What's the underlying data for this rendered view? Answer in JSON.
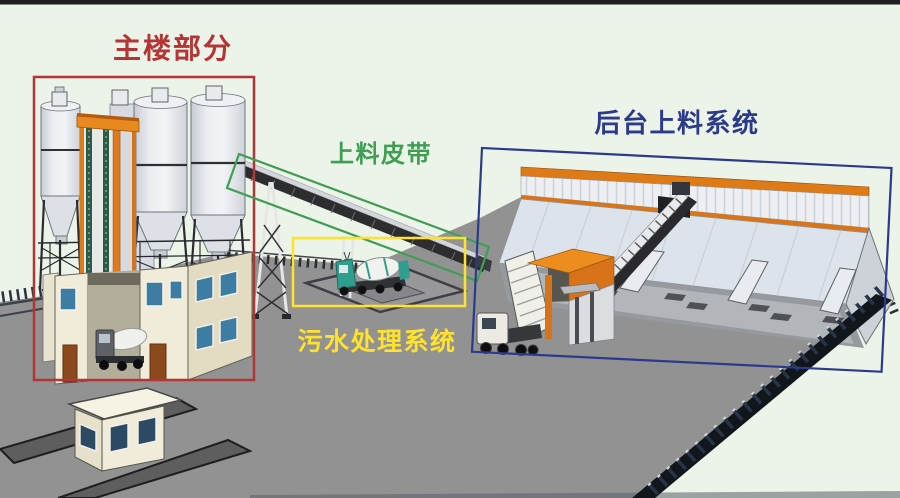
{
  "annotations": {
    "main_building": {
      "label": "主楼部分",
      "color": "#b43535"
    },
    "feeding_belt": {
      "label": "上料皮带",
      "color": "#3f9e52"
    },
    "sewage_treatment": {
      "label": "污水处理系统",
      "color": "#ffe22e"
    },
    "backend_feeding": {
      "label": "后台上料系统",
      "color": "#2c3a8a"
    }
  },
  "colors": {
    "background": "#ecf3e9",
    "ground": "#929292",
    "plant_orange": "#df7b16",
    "silo_gray": "#e3e6ec",
    "building_cream": "#f1ecd9",
    "mixer_teal": "#2f9e8e"
  }
}
